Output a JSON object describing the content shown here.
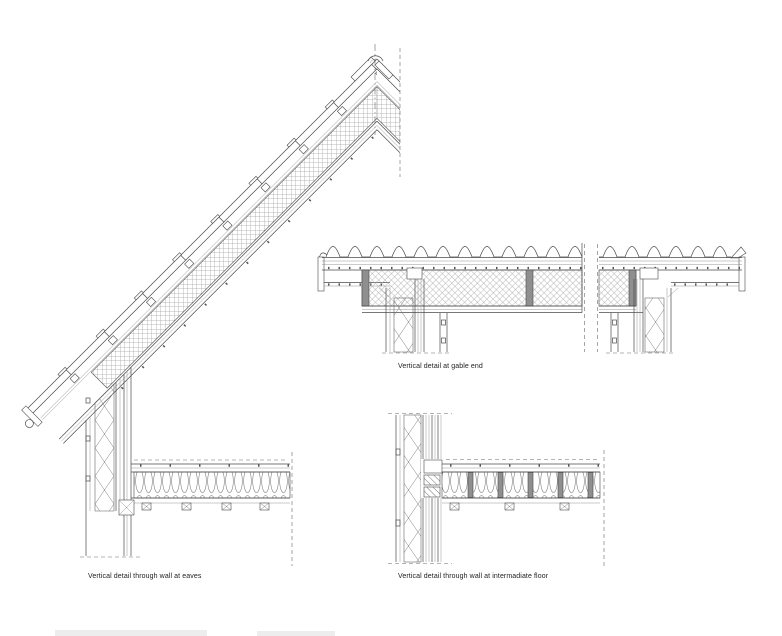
{
  "page": {
    "background": "#ffffff",
    "line_color": "#4a4a4a",
    "hatch_color": "#9a9a9a",
    "stud_fill": "#8f8f8f",
    "dash_color": "#6a6a6a"
  },
  "captions": {
    "eaves": "Vertical detail through wall at eaves",
    "gable": "Vertical detail at gable end",
    "intermediate_floor": "Vertical detail through wall at intermadiate floor"
  }
}
